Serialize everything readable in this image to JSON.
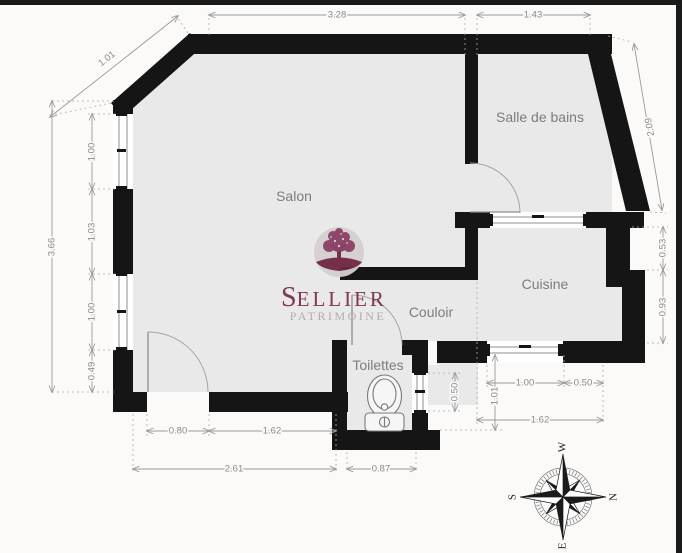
{
  "rooms": {
    "salon": "Salon",
    "salle_de_bains": "Salle de bains",
    "cuisine": "Cuisine",
    "couloir": "Couloir",
    "toilettes": "Toilettes"
  },
  "dimensions": {
    "top_diagonal": "1.01",
    "top_main": "3.28",
    "top_right": "1.43",
    "left_total": "3.66",
    "left_seg1": "1.00",
    "left_seg2": "1.03",
    "left_seg3": "1.00",
    "left_seg4": "0.49",
    "right_slant": "2.09",
    "right_seg1": "0.53",
    "right_seg2": "0.93",
    "bottom_door": "0.80",
    "bottom_wall": "1.62",
    "bottom_total": "2.61",
    "bottom_wc": "0.87",
    "kitchen_window": "1.00",
    "kitchen_right": "0.50",
    "kitchen_height": "1.01",
    "kitchen_total": "1.62",
    "wc_window": "0.50"
  },
  "watermark": {
    "brand_initial": "S",
    "brand_rest": "ELLIER",
    "subtitle": "PATRIMOINE"
  },
  "compass": {
    "north": "N",
    "south": "S",
    "east": "E",
    "west": "W"
  },
  "colors": {
    "wall": "#151515",
    "floor": "#e9e9e9",
    "dimension": "#9a9a9a",
    "room_label": "#7d7d7d",
    "brand_maroon": "#7b2d4e",
    "brand_gray": "#b2a9ad"
  }
}
